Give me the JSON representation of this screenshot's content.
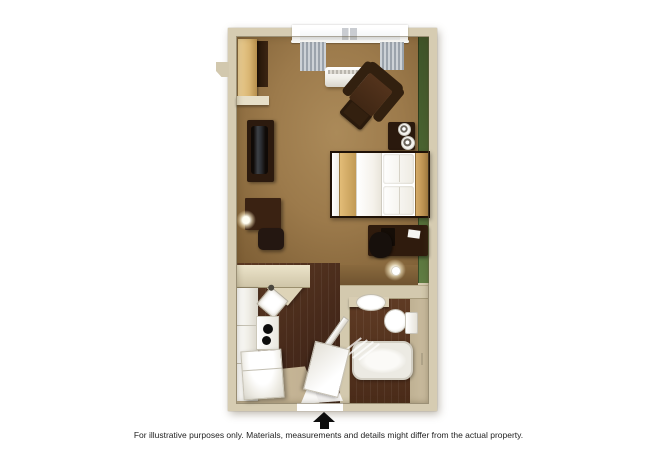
{
  "caption": "For illustrative purposes only.  Materials, measurements and details might differ from the actual property.",
  "floorplan": {
    "type": "3d-studio-suite-floor-plan",
    "rooms": [
      "main-room",
      "kitchenette",
      "bathroom",
      "entry"
    ],
    "furniture_and_fixtures": [
      "wardrobe",
      "shelving-unit",
      "tv-dresser",
      "television",
      "desk",
      "desk-lamp",
      "desk-chair",
      "armchair",
      "ottoman",
      "nightstand",
      "table-lamps",
      "bed",
      "work-table",
      "office-chair",
      "floor-lamp",
      "window-with-curtains",
      "ac-unit",
      "kitchen-counter",
      "kitchen-sink",
      "stove-cooktop",
      "refrigerator",
      "kitchen-cabinets",
      "bathroom-vanity-sink",
      "toilet",
      "bathtub",
      "shower-curtain",
      "bathroom-door",
      "entry-door"
    ],
    "colors": {
      "background": "#ffffff",
      "wall": "#d6ccb2",
      "accent_wall_green": "#4c6433",
      "carpet": "#9c7a4b",
      "wood_floor": "#523320",
      "bath_vinyl_floor": "#c5b79a",
      "dark_wood_furniture": "#2f1b0d",
      "light_wood_furniture": "#d9b572",
      "bedding_white": "#f4f1ea",
      "bed_runner_tan": "#d3ab67",
      "curtain_gray": "#aab2bb"
    }
  },
  "compass": {
    "icon": "north-arrow",
    "direction": "up"
  }
}
